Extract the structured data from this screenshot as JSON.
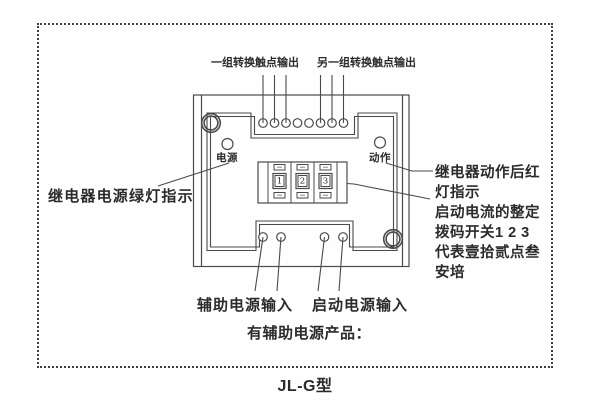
{
  "caption": "JL-G型",
  "diagram": {
    "top_labels": {
      "group1": "一组转换触点输出",
      "group2": "另一组转换触点输出"
    },
    "device": {
      "power_led_label": "电源",
      "action_led_label": "动作",
      "dip_switches": [
        "1",
        "2",
        "3"
      ]
    },
    "left_annotation": "继电器电源绿灯指示",
    "right_annotation_lines": [
      "继电器动作后红",
      "灯指示",
      "启动电流的整定",
      "拨码开关1 2 3",
      "代表壹拾贰点叁",
      "安培"
    ],
    "bottom_labels": {
      "aux_power_input": "辅助电源输入",
      "start_power_input": "启动电源输入",
      "note": "有辅助电源产品："
    }
  },
  "colors": {
    "line": "#4a4a4a",
    "text": "#2b2b2b",
    "frame_border": "#3f3f3f",
    "background": "#fefefe"
  }
}
